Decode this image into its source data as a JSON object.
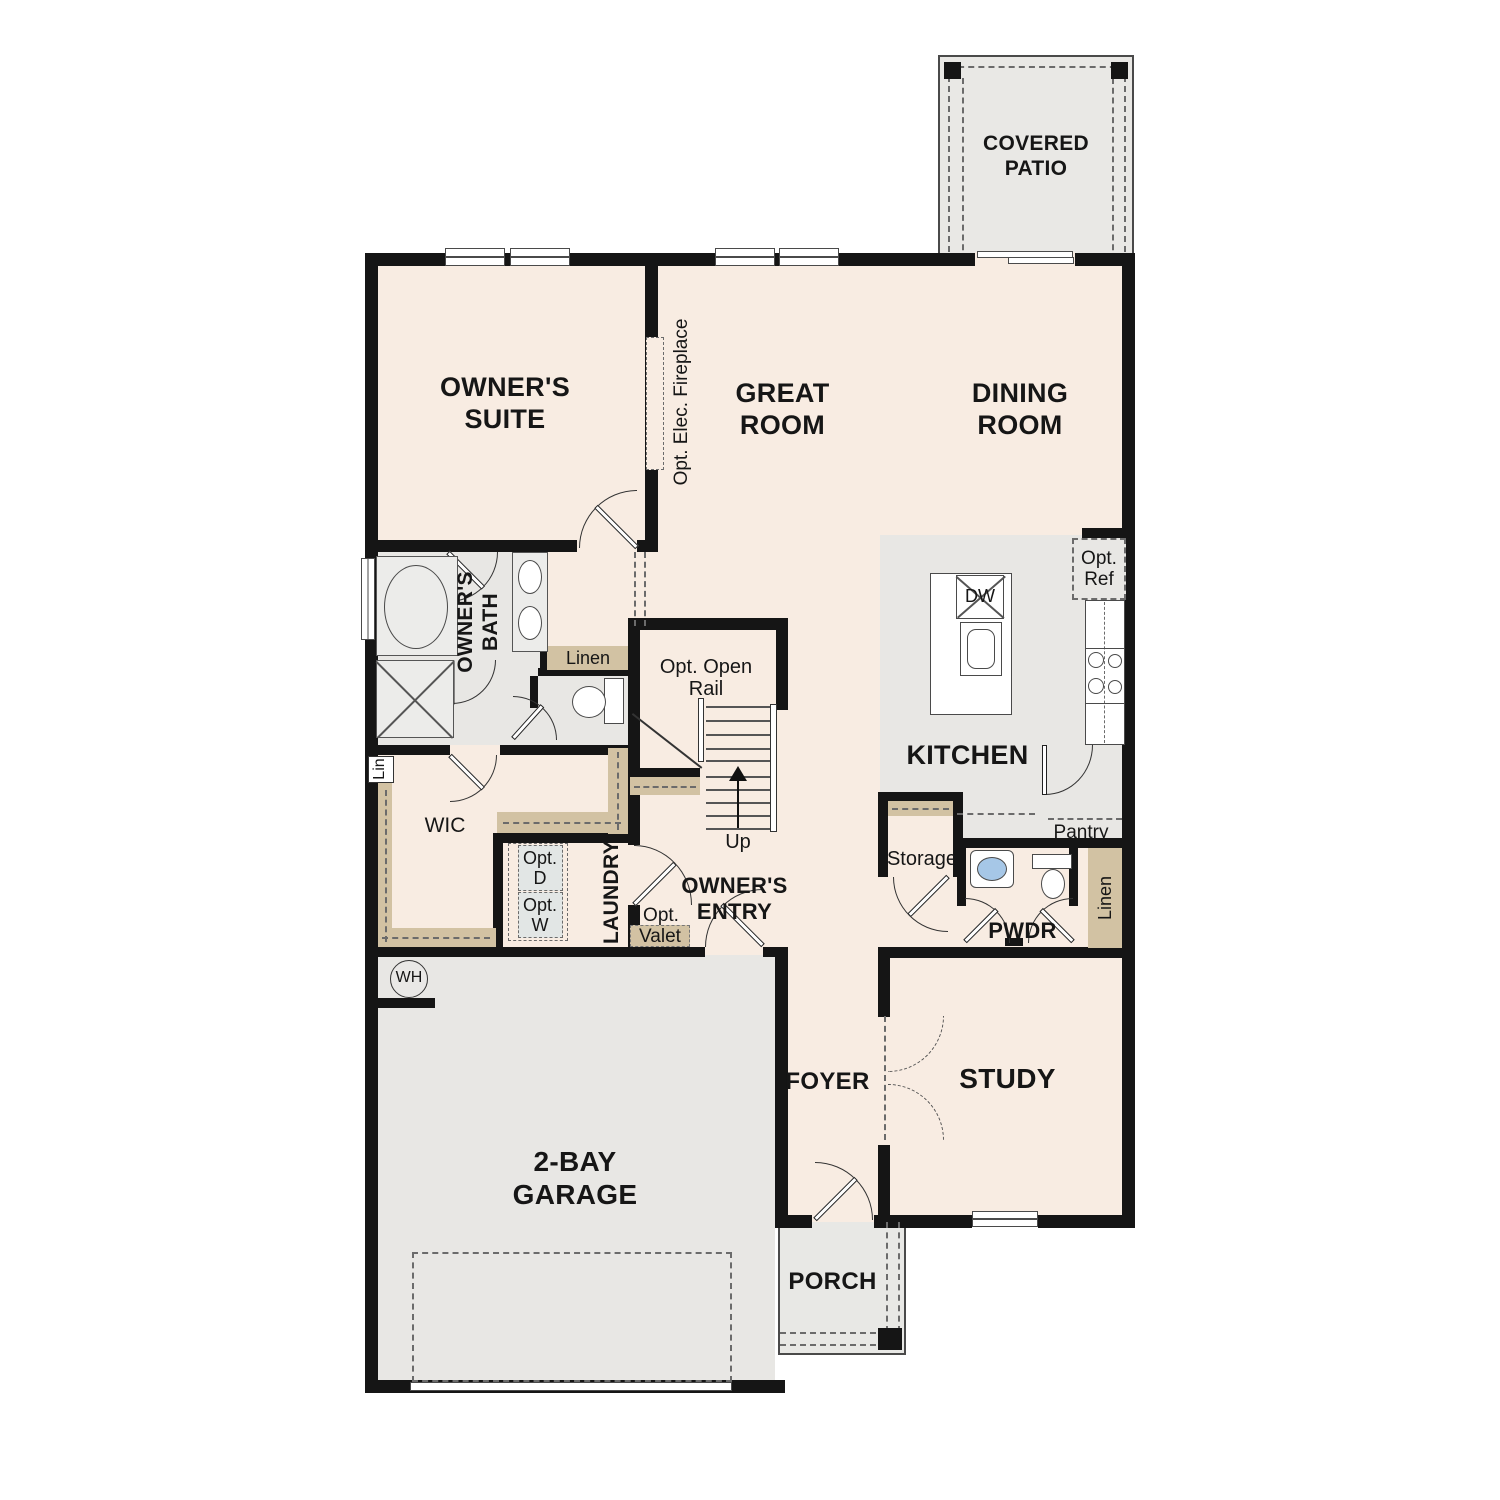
{
  "colors": {
    "floor_living": "#f8ece2",
    "floor_hard": "#e8e7e4",
    "shelf_tan": "#d2c2a3",
    "wall": "#151515",
    "fixture_line": "#4a4a4a",
    "sink_blue": "#a6c7e7"
  },
  "rooms": {
    "covered_patio": "COVERED PATIO",
    "owners_suite": "OWNER'S SUITE",
    "great_room": "GREAT ROOM",
    "dining_room": "DINING ROOM",
    "kitchen": "KITCHEN",
    "owners_bath": "OWNER'S BATH",
    "wic": "WIC",
    "laundry": "LAUNDRY",
    "owners_entry": "OWNER'S ENTRY",
    "pwdr": "PWDR",
    "storage": "Storage",
    "pantry": "Pantry",
    "foyer": "FOYER",
    "study": "STUDY",
    "garage": "2-BAY GARAGE",
    "porch": "PORCH"
  },
  "annotations": {
    "opt_elec_fireplace": "Opt. Elec. Fireplace",
    "opt_open_rail": "Opt. Open Rail",
    "up": "Up",
    "dw": "DW",
    "opt_ref": "Opt. Ref",
    "linen_bath": "Linen",
    "linen_hall": "Linen",
    "lin": "Lin",
    "opt_d": "Opt. D",
    "opt_w": "Opt. W",
    "opt_valet_prefix": "Opt.",
    "opt_valet": "Valet",
    "wh": "WH"
  }
}
